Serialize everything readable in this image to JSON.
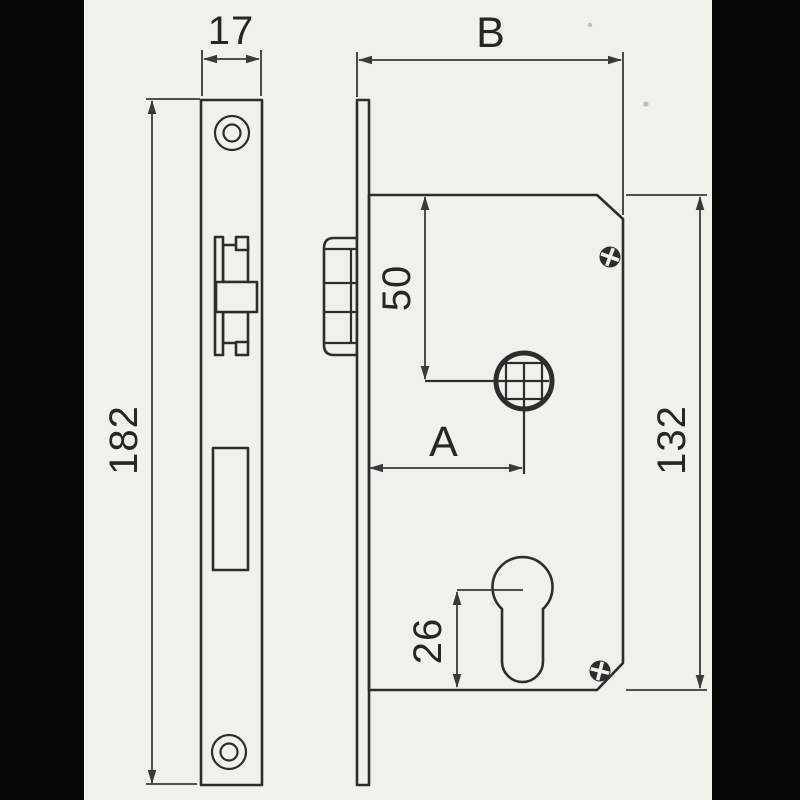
{
  "drawing": {
    "dims": {
      "faceplate_width": "17",
      "case_depth": "B",
      "faceplate_height": "182",
      "follower_from_case_top": "50",
      "backset": "A",
      "case_height": "132",
      "cylinder_from_case_bottom": "26"
    }
  },
  "colors": {
    "ink": "#2d2d2d",
    "dim": "#3a3a3a",
    "text": "#262626",
    "paper": "#f0f0ed",
    "matte": "#060606"
  }
}
